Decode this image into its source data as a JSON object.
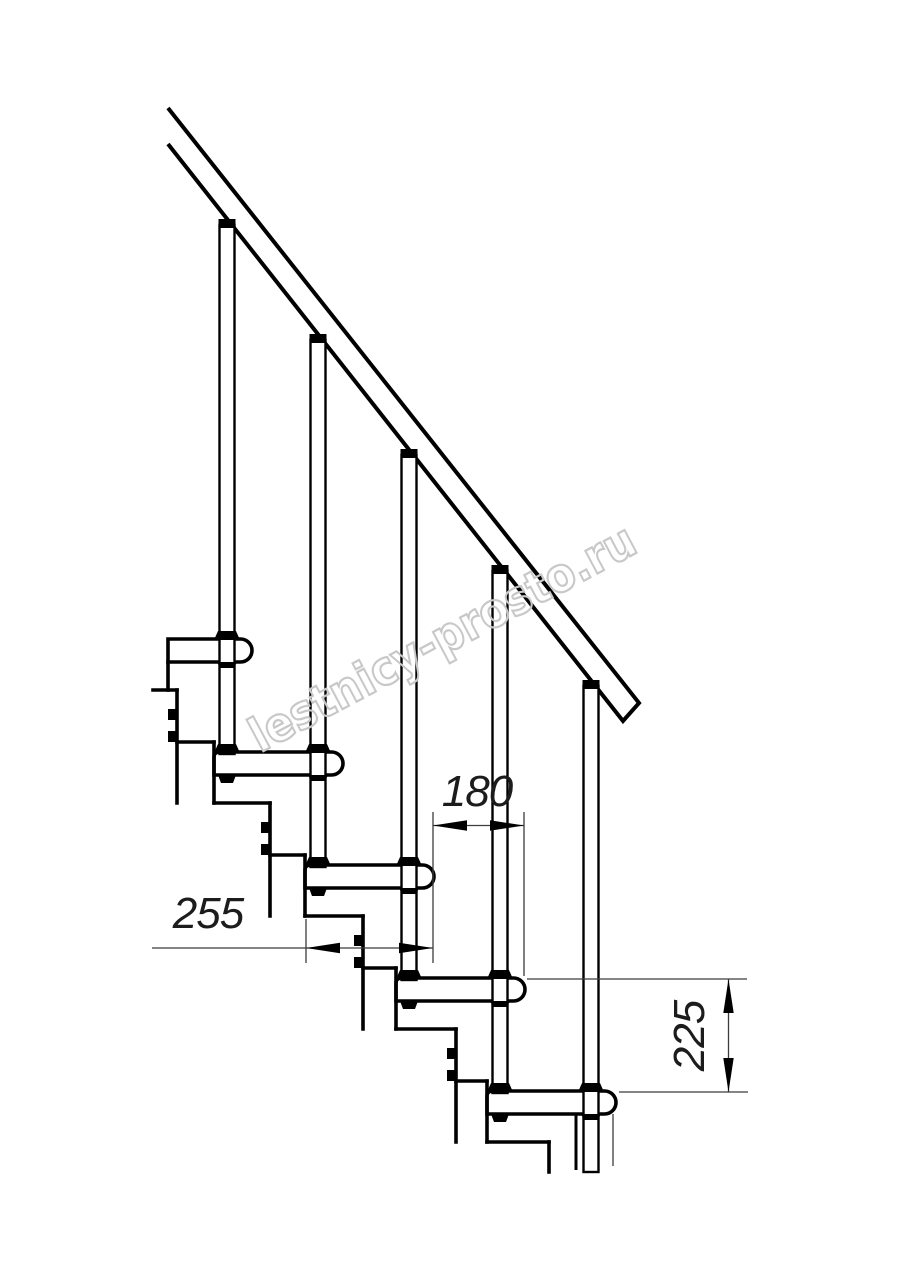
{
  "drawing": {
    "type": "staircase-side-view-technical-drawing",
    "tread_count": 5,
    "baluster_count": 5,
    "colors": {
      "line": "#000000",
      "thin_line": "#3c3c3c",
      "background": "#ffffff"
    }
  },
  "dimensions": {
    "run": {
      "value": "180",
      "orientation": "horizontal"
    },
    "depth": {
      "value": "255",
      "orientation": "horizontal"
    },
    "rise": {
      "value": "225",
      "orientation": "vertical"
    }
  },
  "watermark": {
    "text": "lestnicy-prosto.ru",
    "color": "#c8c8c8"
  }
}
